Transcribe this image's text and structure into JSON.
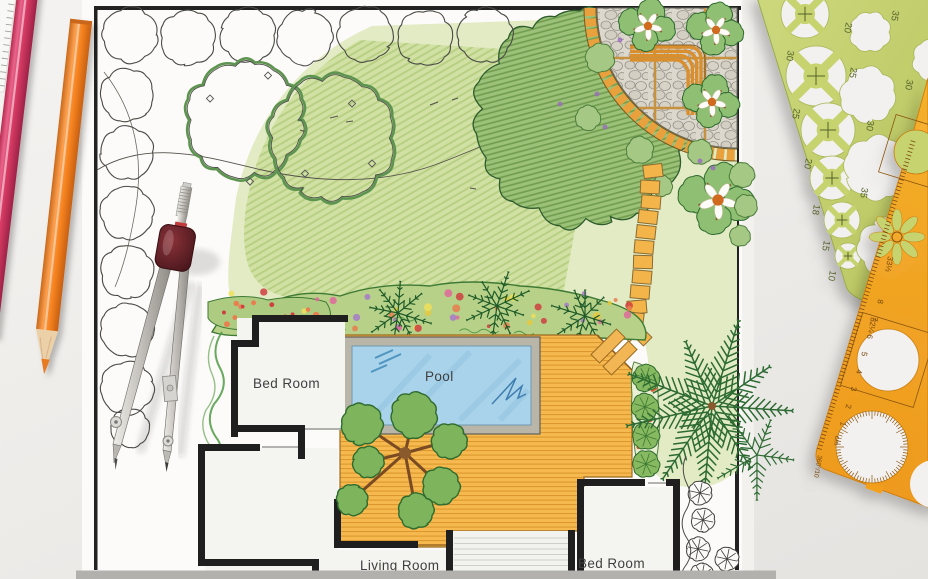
{
  "photo_subject": "garden landscape design plan drawing with drafting tools",
  "plan": {
    "room_labels": {
      "bedroom_top": "Bed Room",
      "living_room": "Living Room",
      "bedroom_bottom": "Bed Room"
    },
    "pool_label": "Pool"
  },
  "green_template": {
    "circle_size_labels": [
      "30",
      "25",
      "20",
      "18",
      "15",
      "10"
    ],
    "shrub_size_labels": [
      "35",
      "20",
      "25",
      "30",
      "30",
      "35"
    ]
  },
  "orange_template": {
    "ruler_numbers": [
      "8",
      "7",
      "6",
      "5",
      "4",
      "3",
      "2",
      "1"
    ],
    "unit_label": "cm",
    "scale_labels": [
      "33⅓",
      "32¼",
      "360°/10"
    ]
  },
  "colors": {
    "lawn": "#e2ebc4",
    "deck": "#f5b94f",
    "pool_water": "#a9d3ea",
    "template_green": "#c6d36e",
    "template_orange": "#f6a41f",
    "pencil_pink": "#d63a63",
    "pencil_orange": "#f5821f",
    "compass_grip": "#5e2026",
    "flower_bed": "#b7d189"
  }
}
